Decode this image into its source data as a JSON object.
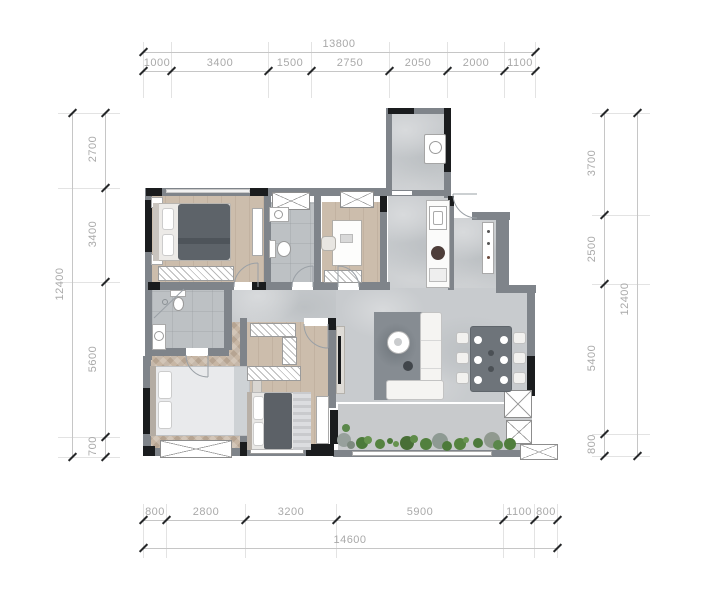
{
  "dimensions": {
    "top": {
      "total": "13800",
      "segments": [
        "1000",
        "3400",
        "1500",
        "2750",
        "2050",
        "2000",
        "1100"
      ]
    },
    "bottom": {
      "total": "14600",
      "segments": [
        "800",
        "2800",
        "3200",
        "5900",
        "1100",
        "800"
      ]
    },
    "left": {
      "total": "12400",
      "segments": [
        "2700",
        "3400",
        "5600",
        "700"
      ]
    },
    "right": {
      "total": "12400",
      "segments": [
        "3700",
        "2500",
        "5400",
        "800"
      ]
    }
  },
  "colors": {
    "wall": "#7f848a",
    "wall_accent": "#1a1c1e",
    "wood_floor": "#c8b9a8",
    "herringbone_floor": "#c7b6a4",
    "marble_floor": "#c8cbce",
    "tile_floor": "#bdc1c4",
    "balcony_floor": "#c8cacc",
    "plant_green": "#4d7a3b",
    "dark_furniture": "#5d6369",
    "dining_table": "#6e747a",
    "dim_text": "#a9a9a9",
    "dim_line": "#c6c6c6",
    "tick": "#26282a"
  },
  "icons": [
    "bed-icon",
    "pillow-icon",
    "wardrobe-icon",
    "dresser-icon",
    "toilet-icon",
    "sink-icon",
    "shower-icon",
    "washer-icon",
    "kitchen-counter-icon",
    "stove-icon",
    "sofa-icon",
    "coffee-table-icon",
    "tv-icon",
    "dining-table-icon",
    "dining-chair-icon",
    "desk-icon",
    "desk-chair-icon",
    "shelf-icon",
    "door-swing-icon",
    "window-icon",
    "bay-window-icon",
    "plant-icon",
    "shoe-cabinet-icon",
    "nightstand-icon",
    "rug-icon",
    "bench-icon"
  ]
}
